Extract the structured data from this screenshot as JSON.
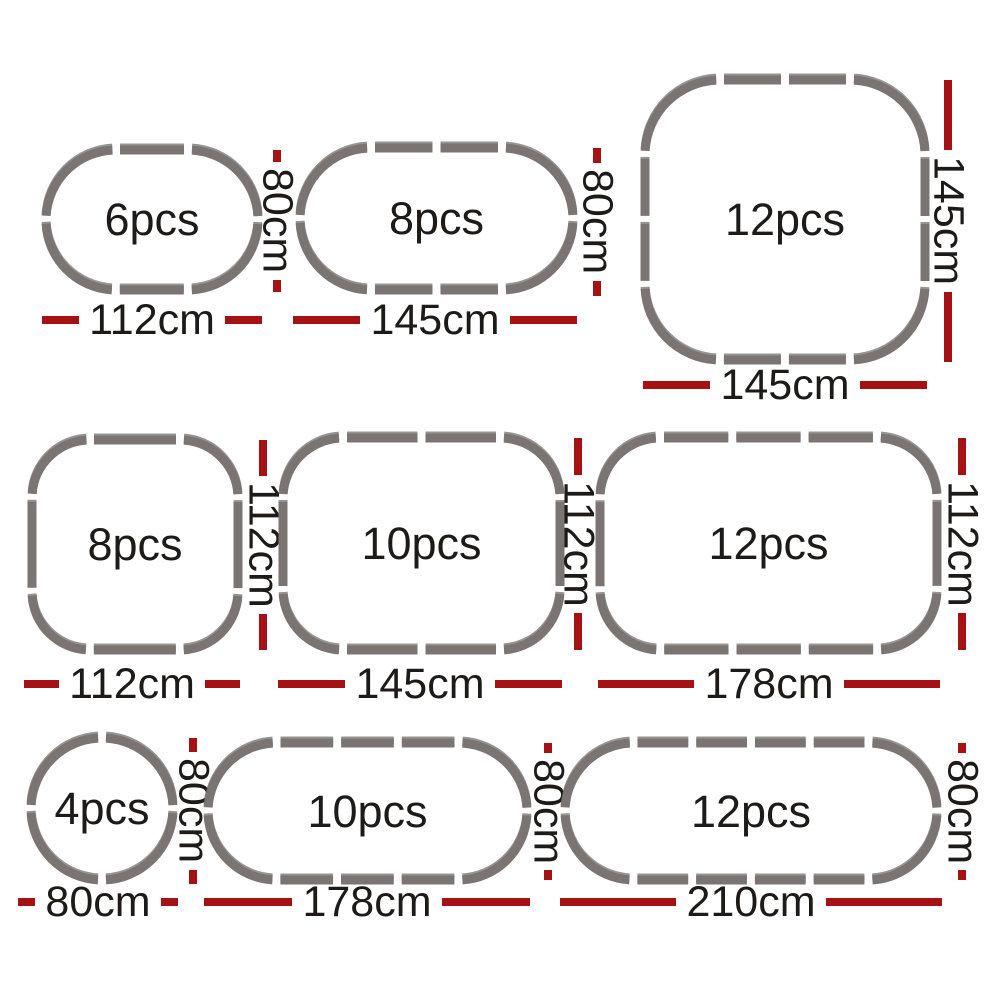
{
  "colors": {
    "background": "#ffffff",
    "track_gray": "#7a7572",
    "track_edge_shadow": "#45413e",
    "dimension_red": "#a61114",
    "text_black": "#1d1a17"
  },
  "diagram": {
    "description": "Playpen configuration size chart",
    "configs": [
      {
        "name": "oval-small",
        "shape": "oval",
        "label": "6pcs",
        "pieces": 6,
        "width": "112cm",
        "height": "80cm",
        "width_cm": 112,
        "height_cm": 80
      },
      {
        "name": "oval-medium",
        "shape": "oval",
        "label": "8pcs",
        "pieces": 8,
        "width": "145cm",
        "height": "80cm",
        "width_cm": 145,
        "height_cm": 80
      },
      {
        "name": "square-large",
        "shape": "square",
        "label": "12pcs",
        "pieces": 12,
        "width": "145cm",
        "height": "145cm",
        "width_cm": 145,
        "height_cm": 145
      },
      {
        "name": "square-small",
        "shape": "square",
        "label": "8pcs",
        "pieces": 8,
        "width": "112cm",
        "height": "112cm",
        "width_cm": 112,
        "height_cm": 112
      },
      {
        "name": "rect-medium",
        "shape": "rect",
        "label": "10pcs",
        "pieces": 10,
        "width": "145cm",
        "height": "112cm",
        "width_cm": 145,
        "height_cm": 112
      },
      {
        "name": "rect-large",
        "shape": "rect",
        "label": "12pcs",
        "pieces": 12,
        "width": "178cm",
        "height": "112cm",
        "width_cm": 178,
        "height_cm": 112
      },
      {
        "name": "circle",
        "shape": "circle",
        "label": "4pcs",
        "pieces": 4,
        "width": "80cm",
        "height": "80cm",
        "width_cm": 80,
        "height_cm": 80
      },
      {
        "name": "stadium-medium",
        "shape": "stadium",
        "label": "10pcs",
        "pieces": 10,
        "width": "178cm",
        "height": "80cm",
        "width_cm": 178,
        "height_cm": 80
      },
      {
        "name": "stadium-large",
        "shape": "stadium",
        "label": "12pcs",
        "pieces": 12,
        "width": "210cm",
        "height": "80cm",
        "width_cm": 210,
        "height_cm": 80
      }
    ]
  }
}
